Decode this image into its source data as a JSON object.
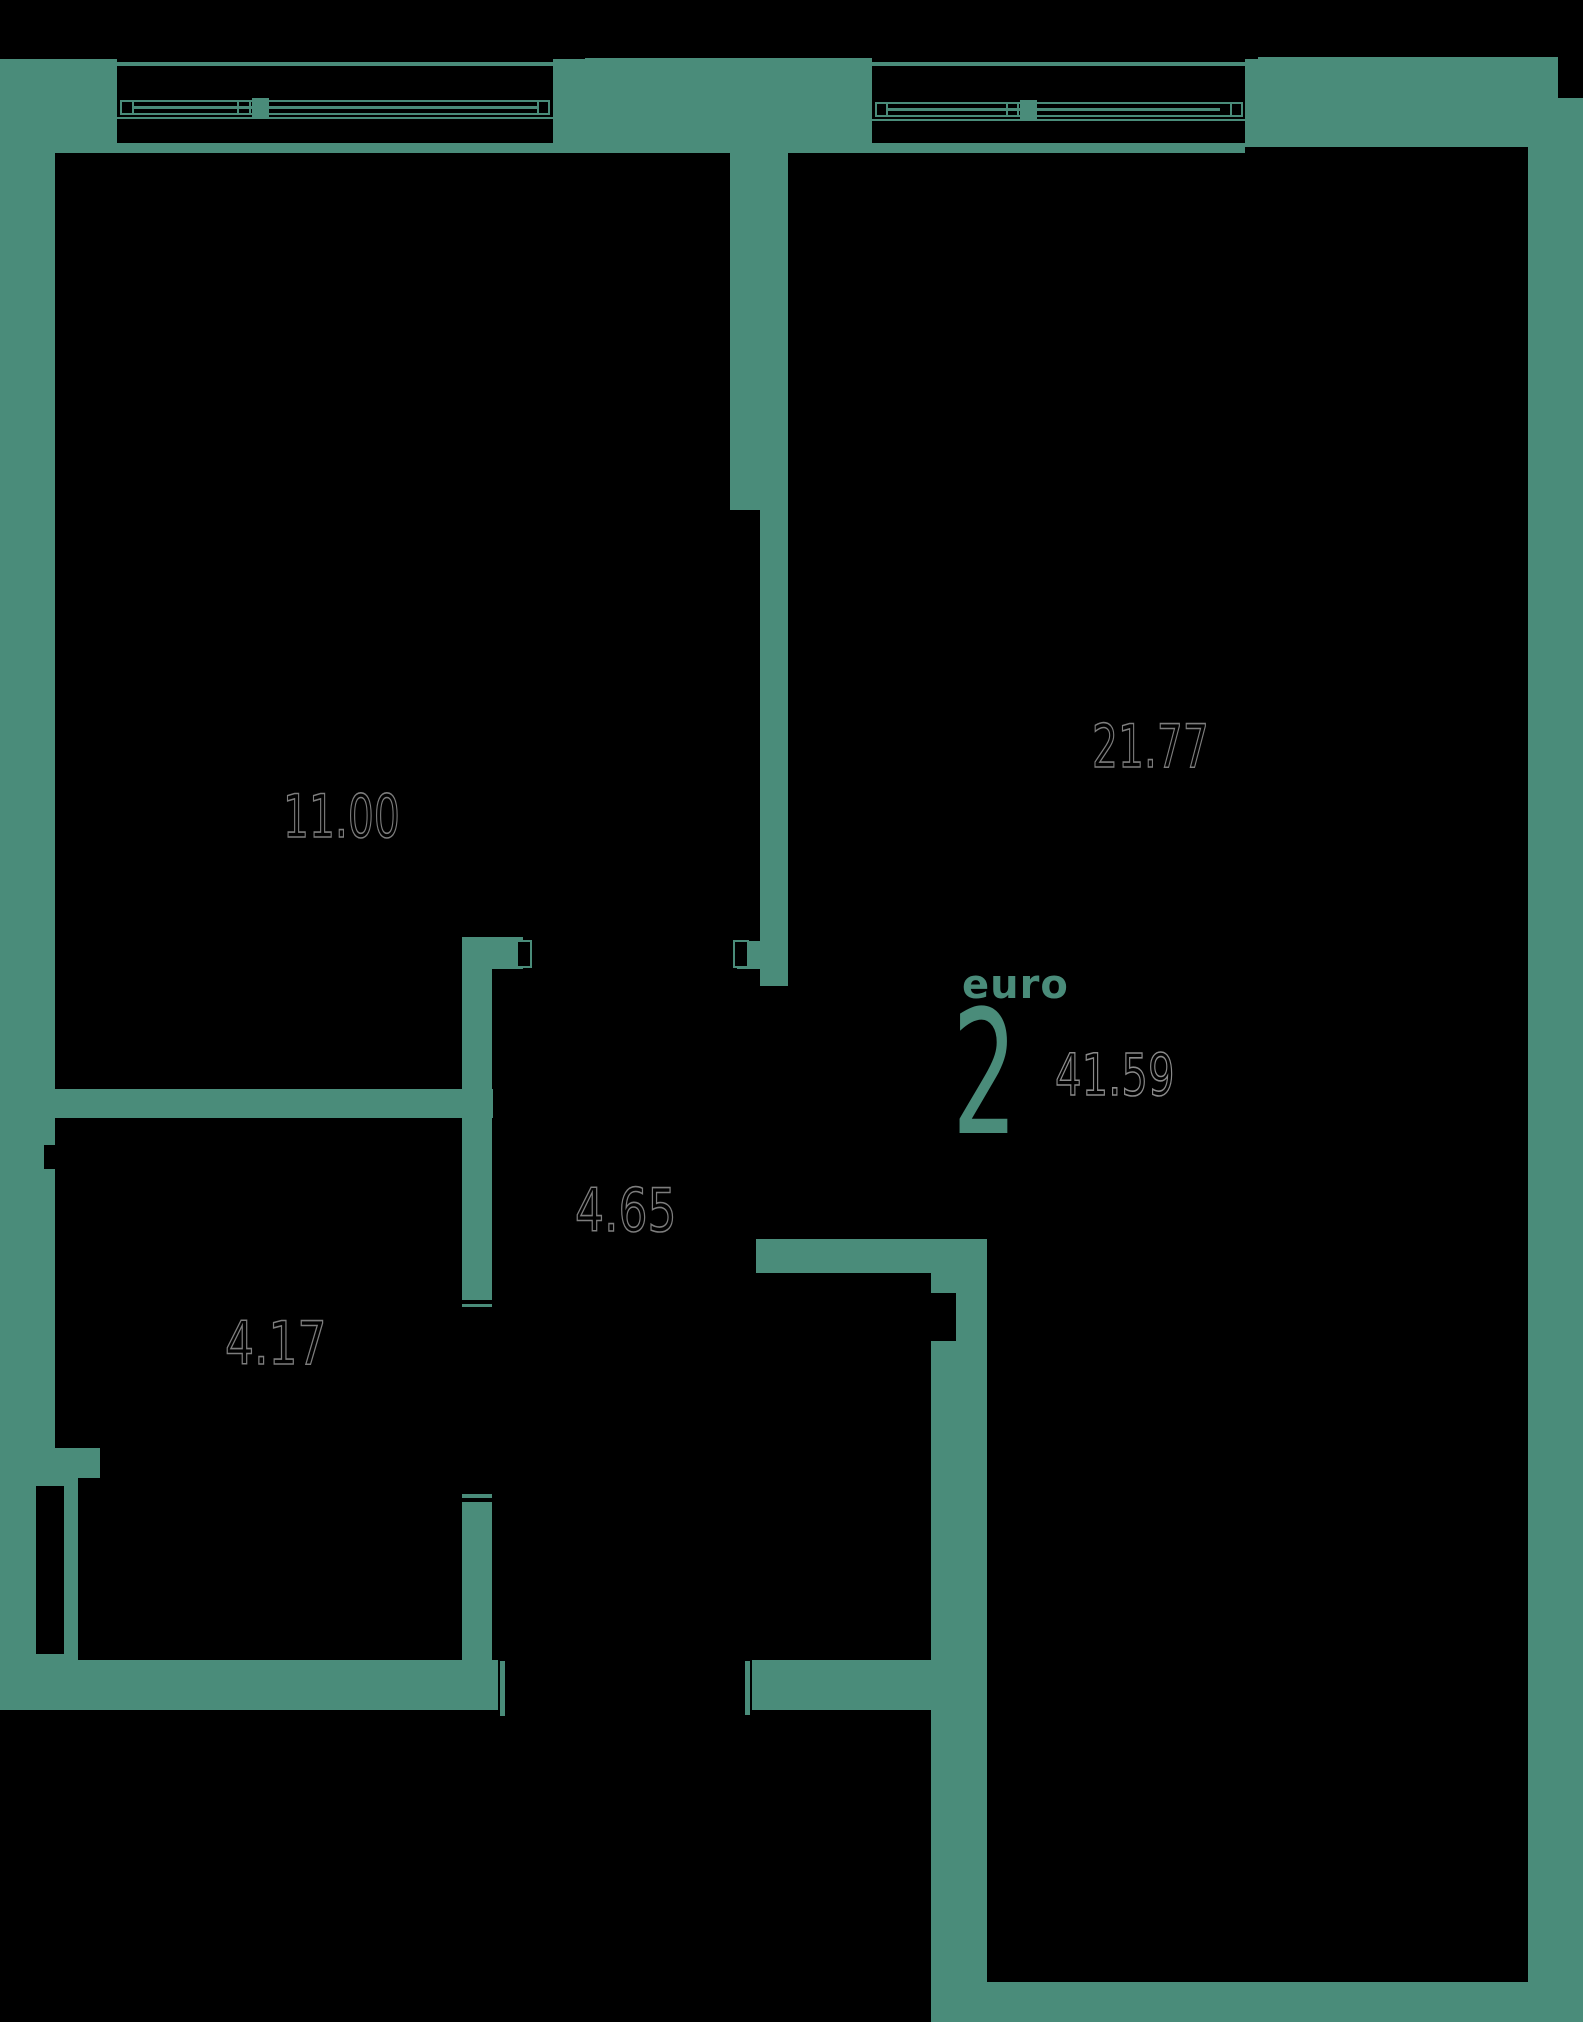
{
  "plan": {
    "unit_type_label": "euro",
    "unit_rooms_count": "2",
    "total_area": "41.59",
    "rooms": [
      {
        "id": "room-top-left",
        "area": "11.00"
      },
      {
        "id": "room-top-right",
        "area": "21.77"
      },
      {
        "id": "hallway",
        "area": "4.65"
      },
      {
        "id": "room-lower-left",
        "area": "4.17"
      }
    ]
  },
  "colors": {
    "wall_teal": "#4a8c7a",
    "background": "#000000",
    "dimension_outline": "#7d7d7d",
    "total_area_outline": "#8a8a8a"
  }
}
